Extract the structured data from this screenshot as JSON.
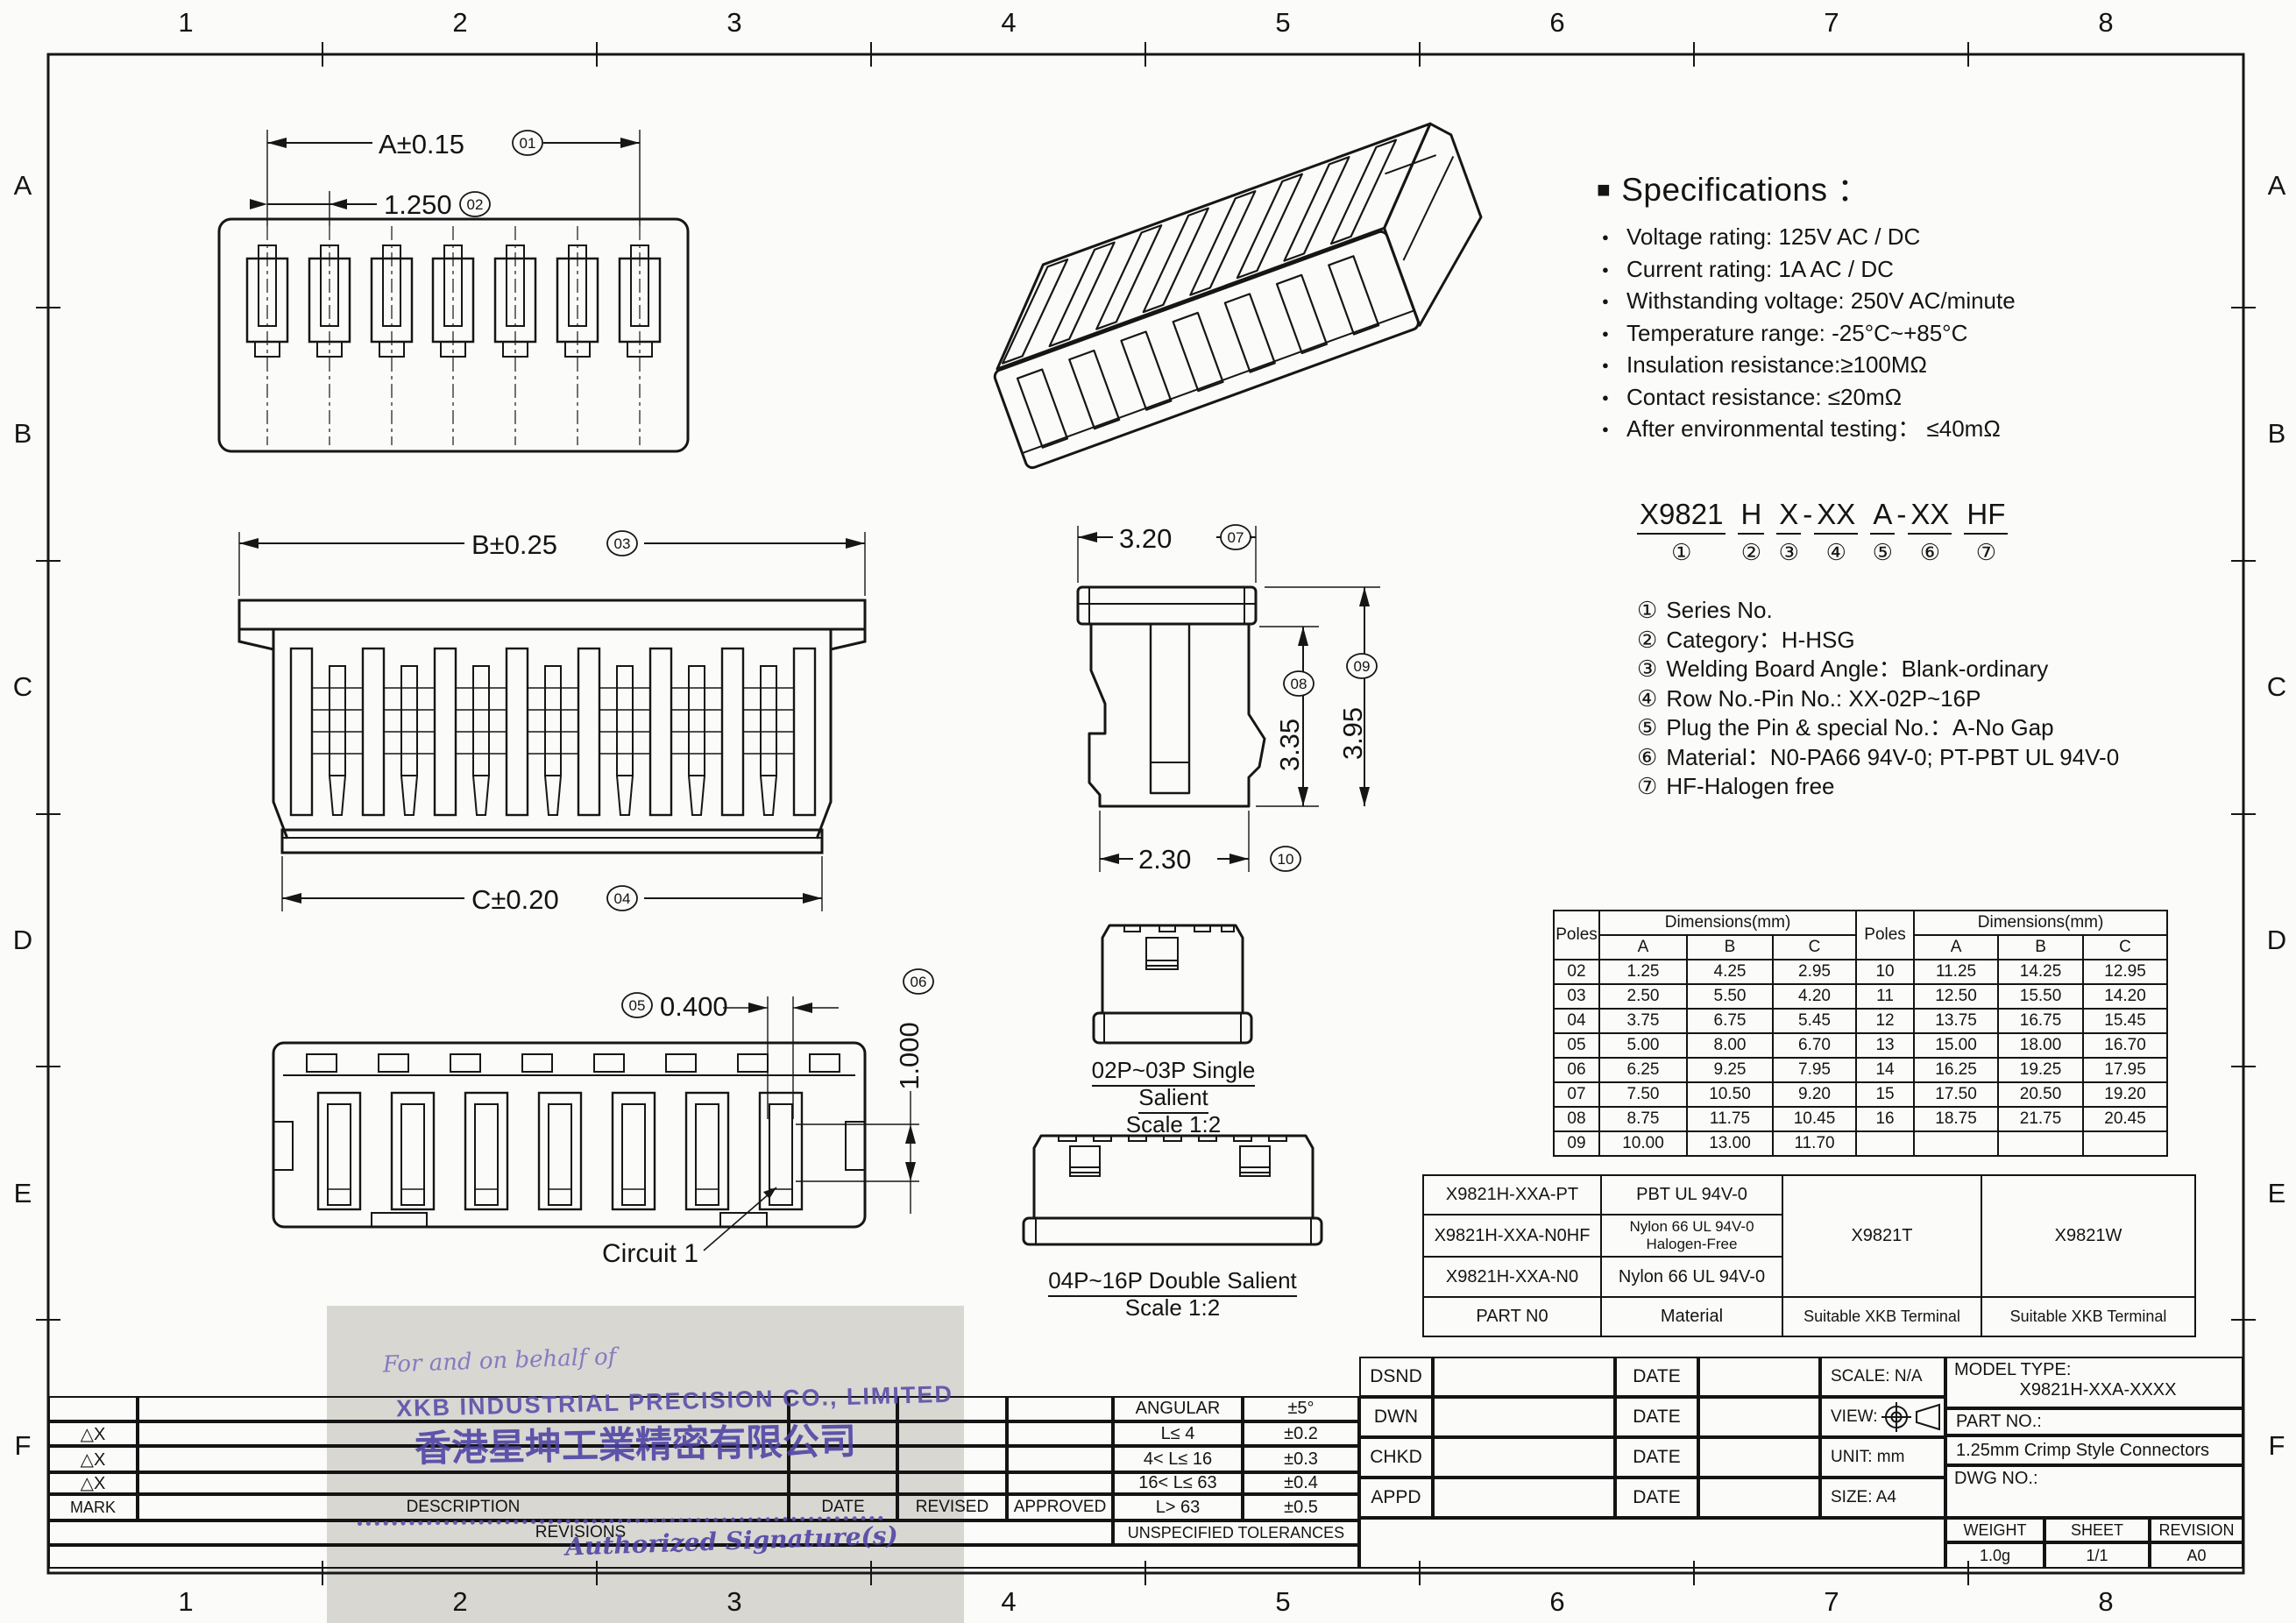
{
  "colors": {
    "ink": "#161616",
    "stamp_purple": "#4d41a4",
    "scan_grey": "#d8d7d2"
  },
  "sheet": {
    "grid_cols": [
      "1",
      "2",
      "3",
      "4",
      "5",
      "6",
      "7",
      "8"
    ],
    "grid_rows": [
      "A",
      "B",
      "C",
      "D",
      "E",
      "F"
    ]
  },
  "specs": {
    "square": "■",
    "heading": "Specifications",
    "colon": "：",
    "items": [
      "Voltage rating: 125V AC / DC",
      "Current rating:  1A  AC / DC",
      "Withstanding voltage: 250V AC/minute",
      "Temperature range: -25°C~+85°C",
      "Insulation resistance:≥100MΩ",
      "Contact resistance: ≤20mΩ",
      "After environmental testing：  ≤40mΩ"
    ]
  },
  "part_code": {
    "parts": [
      {
        "t": "X9821",
        "n": "①"
      },
      {
        "t": "H",
        "n": "②"
      },
      {
        "t": "X",
        "n": "③"
      },
      {
        "t": "-",
        "n": ""
      },
      {
        "t": "XX",
        "n": "④"
      },
      {
        "t": "A",
        "n": "⑤"
      },
      {
        "t": "-",
        "n": ""
      },
      {
        "t": "XX",
        "n": "⑥"
      },
      {
        "t": "HF",
        "n": "⑦"
      }
    ],
    "legend": [
      {
        "num": "①",
        "text": "Series No."
      },
      {
        "num": "②",
        "text": "Category：H-HSG"
      },
      {
        "num": "③",
        "text": "Welding Board Angle：Blank-ordinary"
      },
      {
        "num": "④",
        "text": "Row No.-Pin No.:  XX-02P~16P"
      },
      {
        "num": "⑤",
        "text": "Plug the Pin & special No.：A-No Gap"
      },
      {
        "num": "⑥",
        "text": "Material：N0-PA66 94V-0;  PT-PBT  UL 94V-0"
      },
      {
        "num": "⑦",
        "text": "HF-Halogen free"
      }
    ]
  },
  "views": {
    "top": {
      "dim_a": "A±0.15",
      "dim_a_no": "01",
      "pitch": "1.250",
      "pitch_no": "02"
    },
    "front": {
      "dim_b": "B±0.25",
      "dim_b_no": "03",
      "dim_c": "C±0.20",
      "dim_c_no": "04"
    },
    "side": {
      "width": "3.20",
      "width_no": "07",
      "h1": "3.35",
      "h1_no": "08",
      "h2": "3.95",
      "h2_no": "09",
      "depth": "2.30",
      "depth_no": "10"
    },
    "bottom": {
      "slot": "0.400",
      "slot_no": "05",
      "pitch": "1.000",
      "pitch_no": "06",
      "circuit": "Circuit 1"
    },
    "single": {
      "title": "02P~03P  Single  Salient",
      "scale": "Scale 1:2"
    },
    "double": {
      "title": "04P~16P  Double  Salient",
      "scale": "Scale 1:2"
    }
  },
  "dim_table": {
    "poles": "Poles",
    "dims": "Dimensions(mm)",
    "abc": [
      "A",
      "B",
      "C"
    ],
    "left": [
      [
        "02",
        "1.25",
        "4.25",
        "2.95"
      ],
      [
        "03",
        "2.50",
        "5.50",
        "4.20"
      ],
      [
        "04",
        "3.75",
        "6.75",
        "5.45"
      ],
      [
        "05",
        "5.00",
        "8.00",
        "6.70"
      ],
      [
        "06",
        "6.25",
        "9.25",
        "7.95"
      ],
      [
        "07",
        "7.50",
        "10.50",
        "9.20"
      ],
      [
        "08",
        "8.75",
        "11.75",
        "10.45"
      ],
      [
        "09",
        "10.00",
        "13.00",
        "11.70"
      ]
    ],
    "right": [
      [
        "10",
        "11.25",
        "14.25",
        "12.95"
      ],
      [
        "11",
        "12.50",
        "15.50",
        "14.20"
      ],
      [
        "12",
        "13.75",
        "16.75",
        "15.45"
      ],
      [
        "13",
        "15.00",
        "18.00",
        "16.70"
      ],
      [
        "14",
        "16.25",
        "19.25",
        "17.95"
      ],
      [
        "15",
        "17.50",
        "20.50",
        "19.20"
      ],
      [
        "16",
        "18.75",
        "21.75",
        "20.45"
      ],
      [
        "",
        "",
        "",
        ""
      ]
    ]
  },
  "material_table": {
    "row1": {
      "part": "X9821H-XXA-PT",
      "mat": "PBT  UL 94V-0"
    },
    "row2": {
      "part": "X9821H-XXA-N0HF",
      "mat_a": "Nylon 66  UL 94V-0",
      "mat_b": "Halogen-Free"
    },
    "row3": {
      "part": "X9821H-XXA-N0",
      "mat": "Nylon 66  UL 94V-0"
    },
    "terminal_t": "X9821T",
    "terminal_w": "X9821W",
    "footer": {
      "part": "PART N0",
      "mat": "Material",
      "t": "Suitable XKB Terminal",
      "w": "Suitable XKB Terminal"
    }
  },
  "revisions_block": {
    "delta": "△X",
    "mark": "MARK",
    "description": "DESCRIPTION",
    "date": "DATE",
    "revised": "REVISED",
    "approved": "APPROVED",
    "revisions": "REVISIONS"
  },
  "tolerances": {
    "rows": [
      [
        "ANGULAR",
        "±5°"
      ],
      [
        "L≤ 4",
        "±0.2"
      ],
      [
        "4< L≤ 16",
        "±0.3"
      ],
      [
        "16< L≤ 63",
        "±0.4"
      ],
      [
        "L> 63",
        "±0.5"
      ]
    ],
    "footer": "UNSPECIFIED  TOLERANCES"
  },
  "title_block": {
    "dsnd": "DSND",
    "dwn": "DWN",
    "chkd": "CHKD",
    "appd": "APPD",
    "date_label": "DATE",
    "scale_label": "SCALE: N/A",
    "view_label": "VIEW:",
    "unit_label": "UNIT:  mm",
    "size_label": "SIZE:  A4",
    "model_label": "MODEL TYPE:",
    "model_value": "X9821H-XXA-XXXX",
    "part_label": "PART NO.:",
    "part_value": "1.25mm Crimp Style Connectors",
    "dwg_label": "DWG NO.:",
    "weight_label": "WEIGHT",
    "sheet_label": "SHEET",
    "revision_label": "REVISION",
    "weight_value": "1.0g",
    "sheet_value": "1/1",
    "revision_value": "A0"
  },
  "stamp": {
    "line1": "For and on behalf of",
    "line2": "XKB INDUSTRIAL PRECISION CO., LIMITED",
    "line3": "香港星坤工業精密有限公司",
    "line4": "Authorized  Signature(s)"
  }
}
